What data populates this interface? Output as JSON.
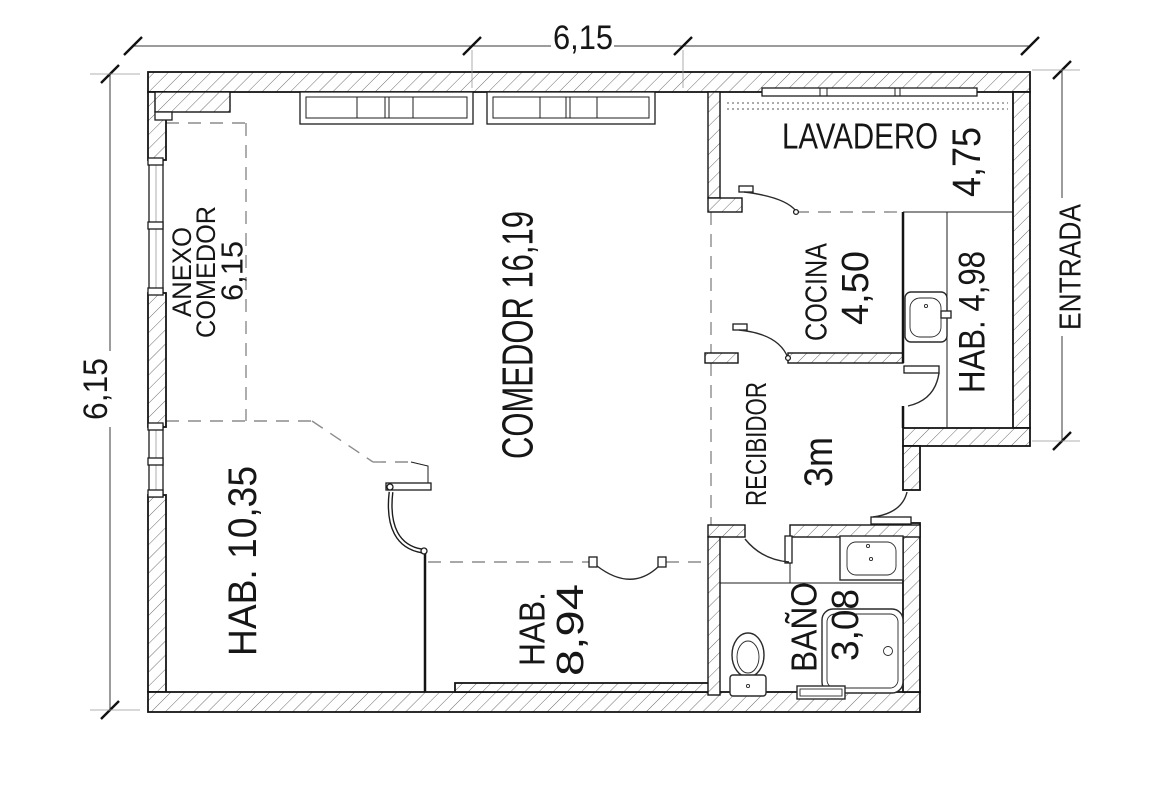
{
  "dimensions": {
    "top_width": "6,15",
    "left_height": "6,15",
    "entrance_label": "ENTRADA"
  },
  "rooms": {
    "anexo_comedor": {
      "name_line1": "ANEXO",
      "name_line2": "COMEDOR",
      "area": "6,15"
    },
    "comedor": {
      "label": "COMEDOR 16,19"
    },
    "lavadero": {
      "name": "LAVADERO",
      "area": "4,75"
    },
    "cocina": {
      "name": "COCINA",
      "area": "4,50"
    },
    "habitacion_498": {
      "label": "HAB. 4,98"
    },
    "recibidor": {
      "name": "RECIBIDOR",
      "area": "3m"
    },
    "habitacion_1035": {
      "label": "HAB. 10,35"
    },
    "habitacion_894": {
      "name": "HAB.",
      "area": "8,94"
    },
    "bano": {
      "name": "BAÑO",
      "area": "3,08"
    }
  },
  "fixtures": [
    "kitchen-sink",
    "bathroom-sink",
    "toilet",
    "bathtub",
    "washer-vent"
  ],
  "colors": {
    "background": "#ffffff",
    "wall_outline": "#141414",
    "hatch_line": "#6e6e6e",
    "dashed_line": "#8c8c8c",
    "text": "#161616"
  }
}
